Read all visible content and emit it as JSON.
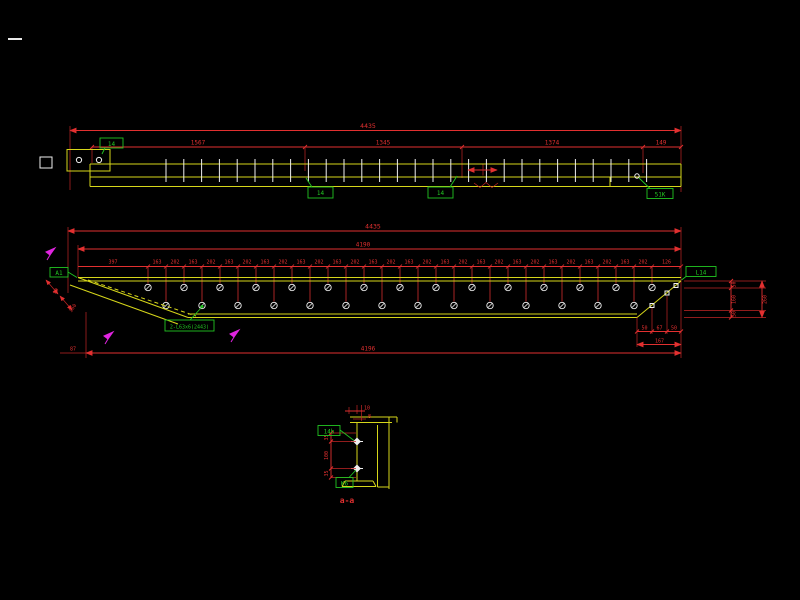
{
  "drawing": {
    "background": "#000000",
    "colors": {
      "dimension_red": "#e23030",
      "member_yellow": "#d6d61a",
      "label_green": "#22c522",
      "detail_white": "#f0f0f0",
      "mark_magenta": "#e024e0"
    },
    "top_view": {
      "total_dim": "4435",
      "segment_dims": [
        "1567",
        "1345",
        "1374",
        "149"
      ],
      "left_plate_label": "14",
      "mid_label_1": "14",
      "mid_label_2": "14",
      "right_label": "51K"
    },
    "middle_view": {
      "total_dim": "4435",
      "inner_dim": "4190",
      "spacing_dims": [
        "397",
        "163",
        "202",
        "163",
        "202",
        "163",
        "202",
        "163",
        "202",
        "163",
        "202",
        "163",
        "202",
        "163",
        "202",
        "163",
        "202",
        "163",
        "202",
        "163",
        "202",
        "163",
        "202",
        "163",
        "202",
        "163",
        "202",
        "163",
        "202",
        "126"
      ],
      "left_label": "A1",
      "member_label": "2-L63x6(2443)",
      "right_label": "L14",
      "right_side_dims": [
        "50",
        "160",
        "50"
      ],
      "right_side_total": "260",
      "end_chain_dims": [
        "50",
        "67",
        "50"
      ],
      "end_chain_total": "167",
      "bottom_left_dim": "87",
      "bottom_total_dim": "4196",
      "diagonal_dims": [
        "90",
        "160"
      ]
    },
    "section_view": {
      "top_dim_1": "10",
      "top_dim_2": "8",
      "side_dims": [
        "35",
        "100",
        "35"
      ],
      "plate_label": "14b",
      "bolt_label": "K6",
      "section_title": "a-a"
    }
  }
}
